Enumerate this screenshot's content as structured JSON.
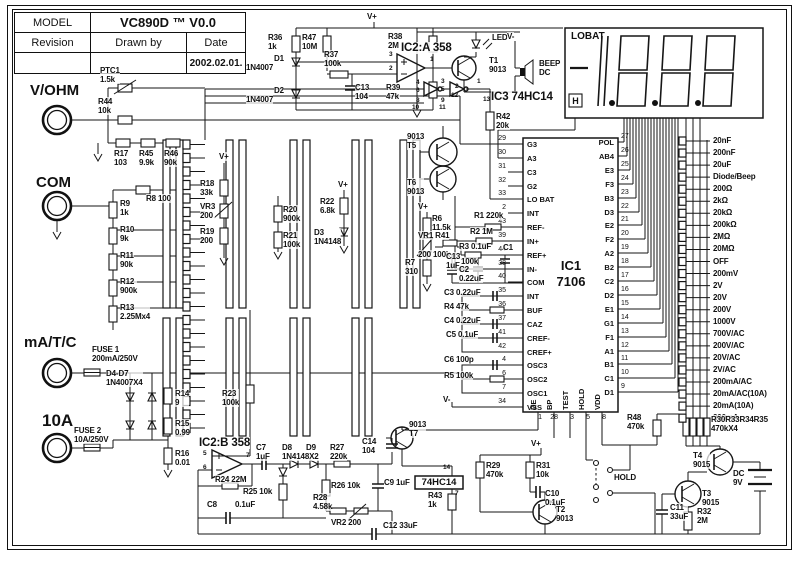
{
  "title_block": {
    "model_label": "MODEL",
    "model_value": "VC890D ™  V0.0",
    "revision_label": "Revision",
    "drawn_by_label": "Drawn by",
    "date_label": "Date",
    "revision_value": "",
    "drawn_by_value": "",
    "date_value": "2002.02.01."
  },
  "terminals": [
    {
      "label": "V/OHM"
    },
    {
      "label": "COM"
    },
    {
      "label": "mA/T/C"
    },
    {
      "label": "10A"
    }
  ],
  "display": {
    "lobat": "LOBAT",
    "hold_symbol": "H",
    "segments": "-1888",
    "decimal_points": 3
  },
  "ic1": {
    "name": "IC1",
    "part": "7106",
    "left_pins": [
      {
        "num": "29",
        "name": "G3"
      },
      {
        "num": "30",
        "name": "A3"
      },
      {
        "num": "31",
        "name": "C3"
      },
      {
        "num": "32",
        "name": "G2"
      },
      {
        "num": "33",
        "name": "LO BAT"
      },
      {
        "num": "2",
        "name": "INT"
      },
      {
        "num": "43",
        "name": "REF-"
      },
      {
        "num": "39",
        "name": "IN+"
      },
      {
        "num": "44",
        "name": "REF+"
      },
      {
        "num": "38",
        "name": "IN-"
      },
      {
        "num": "40",
        "name": "COM"
      },
      {
        "num": "35",
        "name": "INT"
      },
      {
        "num": "36",
        "name": "BUF"
      },
      {
        "num": "37",
        "name": "CAZ"
      },
      {
        "num": "41",
        "name": "CREF-"
      },
      {
        "num": "42",
        "name": "CREF+"
      },
      {
        "num": "4",
        "name": "OSC3"
      },
      {
        "num": "6",
        "name": "OSC2"
      },
      {
        "num": "7",
        "name": "OSC1"
      },
      {
        "num": "34",
        "name": "VSS"
      }
    ],
    "right_pins": [
      {
        "name": "POL",
        "num": "27"
      },
      {
        "name": "AB4",
        "num": "26"
      },
      {
        "name": "E3",
        "num": "25"
      },
      {
        "name": "F3",
        "num": "24"
      },
      {
        "name": "B3",
        "num": "23"
      },
      {
        "name": "D3",
        "num": "22"
      },
      {
        "name": "E2",
        "num": "21"
      },
      {
        "name": "F2",
        "num": "20"
      },
      {
        "name": "A2",
        "num": "19"
      },
      {
        "name": "B2",
        "num": "18"
      },
      {
        "name": "C2",
        "num": "17"
      },
      {
        "name": "D2",
        "num": "16"
      },
      {
        "name": "E1",
        "num": "15"
      },
      {
        "name": "G1",
        "num": "14"
      },
      {
        "name": "F1",
        "num": "13"
      },
      {
        "name": "A1",
        "num": "12"
      },
      {
        "name": "B1",
        "num": "11"
      },
      {
        "name": "C1",
        "num": "10"
      },
      {
        "name": "D1",
        "num": "9"
      }
    ],
    "bottom_pins": [
      {
        "name": "DE",
        "num": "1"
      },
      {
        "name": "BP",
        "num": "28"
      },
      {
        "name": "TEST",
        "num": "3"
      },
      {
        "name": "HOLD",
        "num": "5"
      },
      {
        "name": "VDD",
        "num": "8"
      }
    ]
  },
  "ic4_label": "74HC14",
  "ranges": [
    "20nF",
    "200nF",
    "20uF",
    "Diode/Beep",
    "200Ω",
    "2kΩ",
    "20kΩ",
    "200kΩ",
    "2MΩ",
    "20MΩ",
    "OFF",
    "200mV",
    "2V",
    "20V",
    "200V",
    "1000V",
    "700V/AC",
    "200V/AC",
    "20V/AC",
    "2V/AC",
    "200mA/AC",
    "20mA/AC(10A)",
    "20mA(10A)",
    "200mA"
  ],
  "labels": [
    {
      "t": "PTC1\n1.5k",
      "x": 100,
      "y": 66
    },
    {
      "t": "R44\n10k",
      "x": 98,
      "y": 97
    },
    {
      "t": "R17\n103",
      "x": 114,
      "y": 149
    },
    {
      "t": "R45\n9.9k",
      "x": 139,
      "y": 149
    },
    {
      "t": "R46\n90k",
      "x": 164,
      "y": 149
    },
    {
      "t": "R8  100",
      "x": 146,
      "y": 194
    },
    {
      "t": "R9\n1k",
      "x": 120,
      "y": 199
    },
    {
      "t": "R10\n9k",
      "x": 120,
      "y": 225
    },
    {
      "t": "R11\n90k",
      "x": 120,
      "y": 251
    },
    {
      "t": "R12\n900k",
      "x": 120,
      "y": 277
    },
    {
      "t": "R13\n2.25Mx4",
      "x": 120,
      "y": 303
    },
    {
      "t": "FUSE 1\n200mA/250V",
      "x": 92,
      "y": 345
    },
    {
      "t": "D4-D7\n1N4007X4",
      "x": 106,
      "y": 369
    },
    {
      "t": "R14\n9",
      "x": 175,
      "y": 389
    },
    {
      "t": "R15\n0.99",
      "x": 175,
      "y": 419
    },
    {
      "t": "R16\n0.01",
      "x": 175,
      "y": 449
    },
    {
      "t": "FUSE 2\n10A/250V",
      "x": 74,
      "y": 426
    },
    {
      "t": "R23\n100k",
      "x": 222,
      "y": 389
    },
    {
      "t": "V+",
      "x": 219,
      "y": 152
    },
    {
      "t": "R18\n33k",
      "x": 200,
      "y": 179
    },
    {
      "t": "VR3\n200",
      "x": 200,
      "y": 202
    },
    {
      "t": "R19\n200",
      "x": 200,
      "y": 227
    },
    {
      "t": "R20\n900k",
      "x": 283,
      "y": 205
    },
    {
      "t": "R21\n100k",
      "x": 283,
      "y": 231
    },
    {
      "t": "V+",
      "x": 338,
      "y": 180
    },
    {
      "t": "R22\n6.8k",
      "x": 320,
      "y": 197
    },
    {
      "t": "D3\n1N4148",
      "x": 314,
      "y": 228
    },
    {
      "t": "9013\nT5",
      "x": 407,
      "y": 132
    },
    {
      "t": "T6\n9013",
      "x": 407,
      "y": 178
    },
    {
      "t": "V+",
      "x": 418,
      "y": 202
    },
    {
      "t": "R6\n11.5k",
      "x": 432,
      "y": 214
    },
    {
      "t": "VR1  R41",
      "x": 418,
      "y": 231
    },
    {
      "t": "200  100k",
      "x": 418,
      "y": 250
    },
    {
      "t": "R7\n310",
      "x": 405,
      "y": 258
    },
    {
      "t": "C13\n1uF",
      "x": 446,
      "y": 252
    },
    {
      "t": "R36\n1k",
      "x": 268,
      "y": 33
    },
    {
      "t": "R47\n10M",
      "x": 302,
      "y": 33
    },
    {
      "t": "D1",
      "x": 274,
      "y": 54
    },
    {
      "t": "1N4007",
      "x": 246,
      "y": 63
    },
    {
      "t": "D2",
      "x": 274,
      "y": 86
    },
    {
      "t": "1N4007",
      "x": 246,
      "y": 95
    },
    {
      "t": "R37\n100k",
      "x": 324,
      "y": 50
    },
    {
      "t": "C13\n104",
      "x": 355,
      "y": 83
    },
    {
      "t": "V+",
      "x": 367,
      "y": 12
    },
    {
      "t": "R38\n2M",
      "x": 388,
      "y": 32
    },
    {
      "t": "IC2:A 358",
      "x": 401,
      "y": 42,
      "c": "b12"
    },
    {
      "t": "R39\n47k",
      "x": 386,
      "y": 83
    },
    {
      "t": "3",
      "x": 389,
      "y": 51,
      "c": "t7"
    },
    {
      "t": "2",
      "x": 389,
      "y": 65,
      "c": "t7"
    },
    {
      "t": "1",
      "x": 430,
      "y": 56,
      "c": "t7"
    },
    {
      "t": "LED",
      "x": 492,
      "y": 33
    },
    {
      "t": "T1\n9013",
      "x": 489,
      "y": 56
    },
    {
      "t": "V-",
      "x": 507,
      "y": 32
    },
    {
      "t": "BEEP\nDC",
      "x": 539,
      "y": 59
    },
    {
      "t": "IC3  74HC14",
      "x": 491,
      "y": 91,
      "c": "b12"
    },
    {
      "t": "4",
      "x": 416,
      "y": 79,
      "c": "t7"
    },
    {
      "t": "6",
      "x": 416,
      "y": 87,
      "c": "t7"
    },
    {
      "t": "8",
      "x": 416,
      "y": 97,
      "c": "t7"
    },
    {
      "t": "10",
      "x": 412,
      "y": 104,
      "c": "t7"
    },
    {
      "t": "3",
      "x": 441,
      "y": 78,
      "c": "t7"
    },
    {
      "t": "5",
      "x": 441,
      "y": 86,
      "c": "t7"
    },
    {
      "t": "9",
      "x": 441,
      "y": 97,
      "c": "t7"
    },
    {
      "t": "11",
      "x": 439,
      "y": 104,
      "c": "t7"
    },
    {
      "t": "2",
      "x": 455,
      "y": 83,
      "c": "t7"
    },
    {
      "t": "12",
      "x": 451,
      "y": 92,
      "c": "t7"
    },
    {
      "t": "1",
      "x": 477,
      "y": 78,
      "c": "t7"
    },
    {
      "t": "13",
      "x": 483,
      "y": 96,
      "c": "t7"
    },
    {
      "t": "R42\n20k",
      "x": 496,
      "y": 112
    },
    {
      "t": "R1  220k",
      "x": 474,
      "y": 211
    },
    {
      "t": "R2  1M",
      "x": 470,
      "y": 227
    },
    {
      "t": "R3   0.1uF",
      "x": 459,
      "y": 242
    },
    {
      "t": "C1",
      "x": 503,
      "y": 243
    },
    {
      "t": "100k",
      "x": 461,
      "y": 257
    },
    {
      "t": "C2\n0.22uF",
      "x": 459,
      "y": 265
    },
    {
      "t": "C3  0.22uF",
      "x": 444,
      "y": 288
    },
    {
      "t": "R4  47k",
      "x": 444,
      "y": 302
    },
    {
      "t": "C4  0.22uF",
      "x": 444,
      "y": 316
    },
    {
      "t": "C5  0.1uF",
      "x": 446,
      "y": 330
    },
    {
      "t": "C6  100p",
      "x": 444,
      "y": 355
    },
    {
      "t": "R5  100k",
      "x": 444,
      "y": 371
    },
    {
      "t": "V-",
      "x": 443,
      "y": 395
    },
    {
      "t": "R48\n470k",
      "x": 627,
      "y": 413
    },
    {
      "t": "R30R33R34R35\n470kX4",
      "x": 711,
      "y": 415
    },
    {
      "t": "IC2:B 358",
      "x": 199,
      "y": 437,
      "c": "b12"
    },
    {
      "t": "5",
      "x": 203,
      "y": 450,
      "c": "t7"
    },
    {
      "t": "6",
      "x": 203,
      "y": 464,
      "c": "t7"
    },
    {
      "t": "7",
      "x": 246,
      "y": 452,
      "c": "t7"
    },
    {
      "t": "R24 22M",
      "x": 215,
      "y": 475
    },
    {
      "t": "C7\n1uF",
      "x": 256,
      "y": 443
    },
    {
      "t": "D8\n1N4148X2",
      "x": 282,
      "y": 443
    },
    {
      "t": "D9",
      "x": 306,
      "y": 443
    },
    {
      "t": "R27\n220k",
      "x": 330,
      "y": 443
    },
    {
      "t": "R25 10k",
      "x": 243,
      "y": 487
    },
    {
      "t": "R26 10k",
      "x": 331,
      "y": 481
    },
    {
      "t": "R28\n4.58k",
      "x": 313,
      "y": 493
    },
    {
      "t": "VR2 200",
      "x": 331,
      "y": 518
    },
    {
      "t": "C8",
      "x": 207,
      "y": 500
    },
    {
      "t": "0.1uF",
      "x": 235,
      "y": 500
    },
    {
      "t": "C9  1uF",
      "x": 384,
      "y": 478
    },
    {
      "t": "C12  33uF",
      "x": 383,
      "y": 521
    },
    {
      "t": "C14\n104",
      "x": 362,
      "y": 437
    },
    {
      "t": "9013\nT7",
      "x": 409,
      "y": 420
    },
    {
      "t": "14",
      "x": 443,
      "y": 464,
      "c": "t7"
    },
    {
      "t": "7",
      "x": 455,
      "y": 490,
      "c": "t7"
    },
    {
      "t": "R43\n1k",
      "x": 428,
      "y": 491
    },
    {
      "t": "R29\n470k",
      "x": 486,
      "y": 461
    },
    {
      "t": "R31\n10k",
      "x": 536,
      "y": 461
    },
    {
      "t": "C10\n0.1uF",
      "x": 545,
      "y": 489
    },
    {
      "t": "T2\n9013",
      "x": 556,
      "y": 505
    },
    {
      "t": "V+",
      "x": 531,
      "y": 439
    },
    {
      "t": "HOLD",
      "x": 614,
      "y": 473
    },
    {
      "t": "T4\n9015",
      "x": 693,
      "y": 451
    },
    {
      "t": "T3\n9015",
      "x": 702,
      "y": 489
    },
    {
      "t": "DC\n9V",
      "x": 733,
      "y": 469
    },
    {
      "t": "C11\n33uF",
      "x": 670,
      "y": 503
    },
    {
      "t": "R32\n2M",
      "x": 697,
      "y": 507
    }
  ]
}
